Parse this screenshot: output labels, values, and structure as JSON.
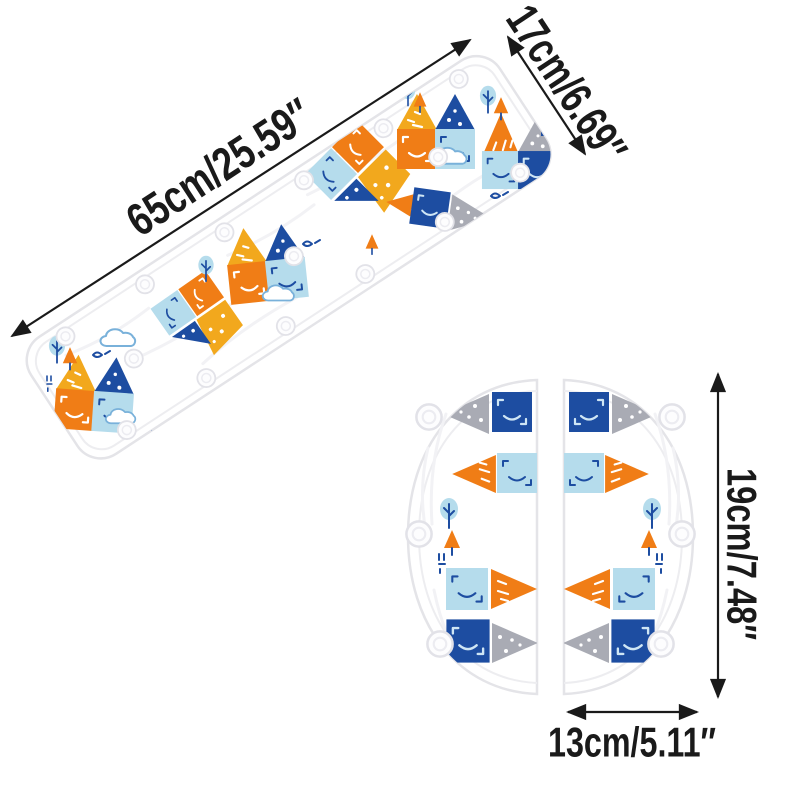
{
  "image_type": "product dimension photo of baby seat-belt pad set",
  "labels": {
    "strip_length": "65cm/25.59″",
    "strip_width": "17cm/6.69″",
    "pad_height": "19cm/7.48″",
    "pad_width": "13cm/5.11″"
  },
  "palette": {
    "navy": "#1d4da1",
    "light_blue": "#b5dcec",
    "sky_blue": "#79b1da",
    "orange": "#f07d16",
    "amber": "#f2a81d",
    "gray": "#a9abb4",
    "fabric_edge": "#e4e4e8",
    "hem": "#ededf0",
    "wrinkle": "#f2f2f5",
    "annotation": "#1a1a1a",
    "background": "#ffffff"
  }
}
